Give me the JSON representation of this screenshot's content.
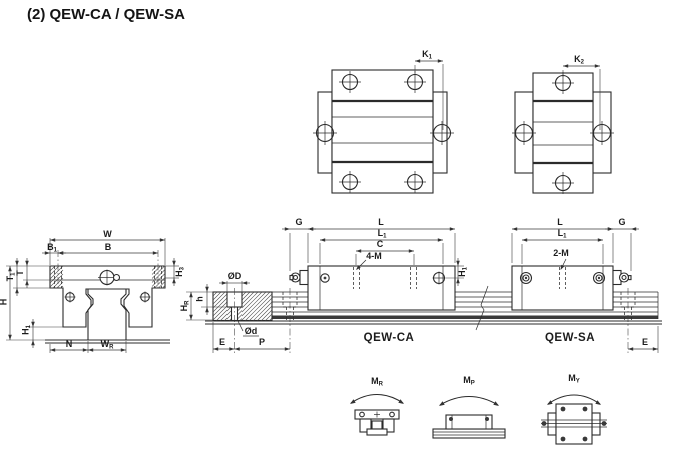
{
  "title": "(2) QEW-CA / QEW-SA",
  "colors": {
    "line": "#2b2b2b",
    "text": "#1c1c1c",
    "background": "#ffffff",
    "rail_band": "#3a3a3a"
  },
  "top_view_ca": {
    "k_dim": {
      "base": "K",
      "sub": "1"
    }
  },
  "top_view_sa": {
    "k_dim": {
      "base": "K",
      "sub": "2"
    }
  },
  "front_view": {
    "dims": {
      "w": {
        "base": "W",
        "sub": ""
      },
      "b": {
        "base": "B",
        "sub": ""
      },
      "b1": {
        "base": "B",
        "sub": "1"
      },
      "t": {
        "base": "T",
        "sub": ""
      },
      "t1": {
        "base": "T",
        "sub": "1"
      },
      "h": {
        "base": "H",
        "sub": ""
      },
      "h1": {
        "base": "H",
        "sub": "1"
      },
      "h3": {
        "base": "H",
        "sub": "3"
      },
      "n": {
        "base": "N",
        "sub": ""
      },
      "wr": {
        "base": "W",
        "sub": "R"
      }
    }
  },
  "rail_section": {
    "dims": {
      "od": {
        "base": "ØD",
        "sub": ""
      },
      "odd": {
        "base": "Ød",
        "sub": ""
      },
      "h": {
        "base": "h",
        "sub": ""
      },
      "hr": {
        "base": "H",
        "sub": "R"
      },
      "e": {
        "base": "E",
        "sub": ""
      },
      "p": {
        "base": "P",
        "sub": ""
      }
    }
  },
  "side_view_ca": {
    "label": "QEW-CA",
    "dims": {
      "g": {
        "base": "G",
        "sub": ""
      },
      "l": {
        "base": "L",
        "sub": ""
      },
      "l1": {
        "base": "L",
        "sub": "1"
      },
      "c": {
        "base": "C",
        "sub": ""
      },
      "m": {
        "base": "4-M",
        "sub": ""
      },
      "h1": {
        "base": "H",
        "sub": "1"
      }
    }
  },
  "side_view_sa": {
    "label": "QEW-SA",
    "dims": {
      "l": {
        "base": "L",
        "sub": ""
      },
      "l1": {
        "base": "L",
        "sub": "1"
      },
      "m": {
        "base": "2-M",
        "sub": ""
      },
      "g": {
        "base": "G",
        "sub": ""
      },
      "e": {
        "base": "E",
        "sub": ""
      }
    }
  },
  "moments": {
    "mr": {
      "base": "M",
      "sub": "R"
    },
    "mp": {
      "base": "M",
      "sub": "P"
    },
    "my": {
      "base": "M",
      "sub": "Y"
    }
  }
}
